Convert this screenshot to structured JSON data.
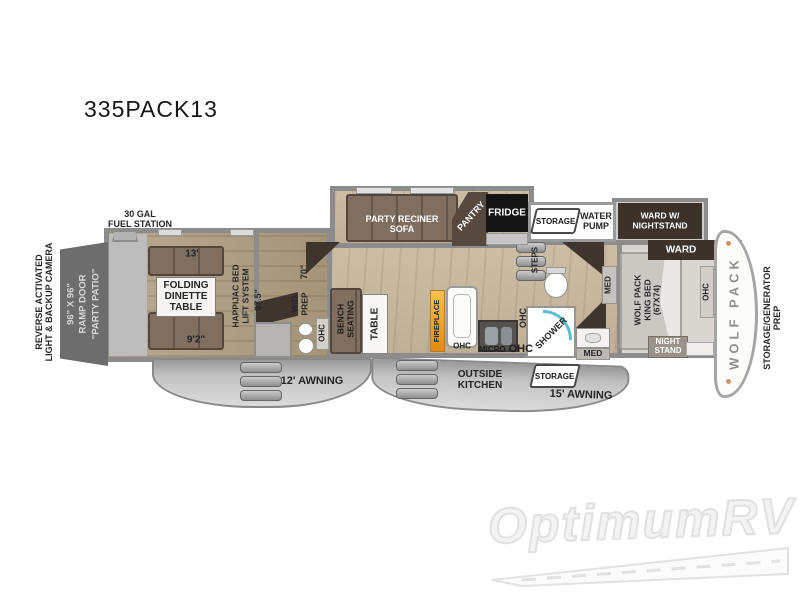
{
  "title": "335PACK13",
  "watermark": "OptimumRV",
  "colors": {
    "wall": "#8c8c8c",
    "floor_wood": "#c3b49c",
    "garage_floor": "#ab9b80",
    "bedroom_carpet": "#d9d6d1",
    "cabinet_dark": "#3f352c",
    "fireplace_accent": "#f0a02c",
    "shower_accent": "#58c0cc"
  },
  "exterior": {
    "rear_camera": "REVERSE ACTIVATED\nLIGHT & BACKUP CAMERA",
    "ramp_door": "96\" X 96\"\nRAMP DOOR\n\"PARTY PATIO\"",
    "fuel_station": "30 GAL\nFUEL STATION",
    "awning_left": "12' AWNING",
    "awning_right": "15' AWNING",
    "outside_kitchen": "OUTSIDE\nKITCHEN",
    "storage_rear": "STORAGE",
    "storage_front": "STORAGE",
    "water_pump": "WATER\nPUMP",
    "front_cap": "WOLF PACK",
    "generator_prep": "STORAGE/GENERATOR\nPREP"
  },
  "garage": {
    "length": "13'",
    "width_rear": "9'2\"",
    "height": "97.5\"",
    "dinette": "FOLDING\nDINETTE\nTABLE",
    "bed_lift": "HAPPIJAC BED\nLIFT SYSTEM",
    "closet_dim": "70\"",
    "wd_prep": "W/D\nPREP",
    "ohc": "OHC"
  },
  "living": {
    "sofa": "PARTY RECINER\nSOFA",
    "pantry": "PANTRY",
    "fridge": "FRIDGE",
    "bench_seating": "BENCH\nSEATING",
    "table": "TABLE",
    "fireplace": "FIREPLACE",
    "ohc_fireplace": "OHC",
    "micro": "MICRO",
    "ohc_kitchen": "OHC",
    "ohc_wall": "OHC",
    "steps": "STEPS"
  },
  "bathroom": {
    "shower": "SHOWER",
    "med_upper": "MED",
    "med_lower": "MED"
  },
  "bedroom": {
    "ward_slide": "WARD W/\nNIGHTSTAND",
    "ward": "WARD",
    "bed": "WOLF PACK\nKING BED\n(67X74)",
    "night_stand": "NIGHT\nSTAND",
    "ohc": "OHC"
  }
}
